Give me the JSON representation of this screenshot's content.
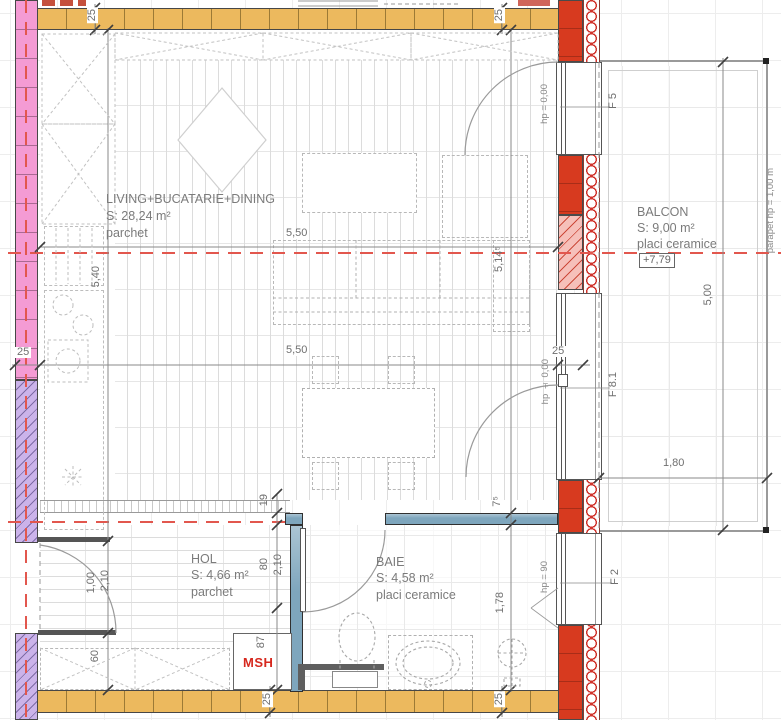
{
  "rooms": {
    "living": {
      "name": "LIVING+BUCATARIE+DINING",
      "area": "S: 28,24 m²",
      "floor": "parchet"
    },
    "hol": {
      "name": "HOL",
      "area": "S: 4,66 m²",
      "floor": "parchet"
    },
    "baie": {
      "name": "BAIE",
      "area": "S: 4,58 m²",
      "floor": "placi ceramice"
    },
    "balcon": {
      "name": "BALCON",
      "area": "S: 9,00 m²",
      "floor": "placi ceramice",
      "level": "+7,79"
    }
  },
  "windows": {
    "f5": "F 5",
    "f81": "F 8.1",
    "f2": "F 2"
  },
  "heights": {
    "f5": "hp = 0,00",
    "f81": "hp ± 0,00",
    "f2": "hp = 90",
    "parapet": "parapet hp = 1,00 m"
  },
  "shaft": {
    "label": "MSH"
  },
  "dims": {
    "d550": "5,50",
    "d540": "5,40",
    "d5145": "5,14⁵",
    "d500": "5,00",
    "d180": "1,80",
    "d178": "1,78",
    "d100": "1,00",
    "d210": "2,10",
    "d80": "80",
    "d60": "60",
    "d87": "87",
    "d19": "19",
    "d75": "7⁵",
    "d25": "25"
  },
  "colors": {
    "wall_exterior_red": "#d73a1f",
    "wall_orange": "#ecb95e",
    "wall_pink": "#f49bd4",
    "wall_purple": "#cbb3ea",
    "wall_blue": "#7ea6bd",
    "axis_red": "#e2574e"
  }
}
